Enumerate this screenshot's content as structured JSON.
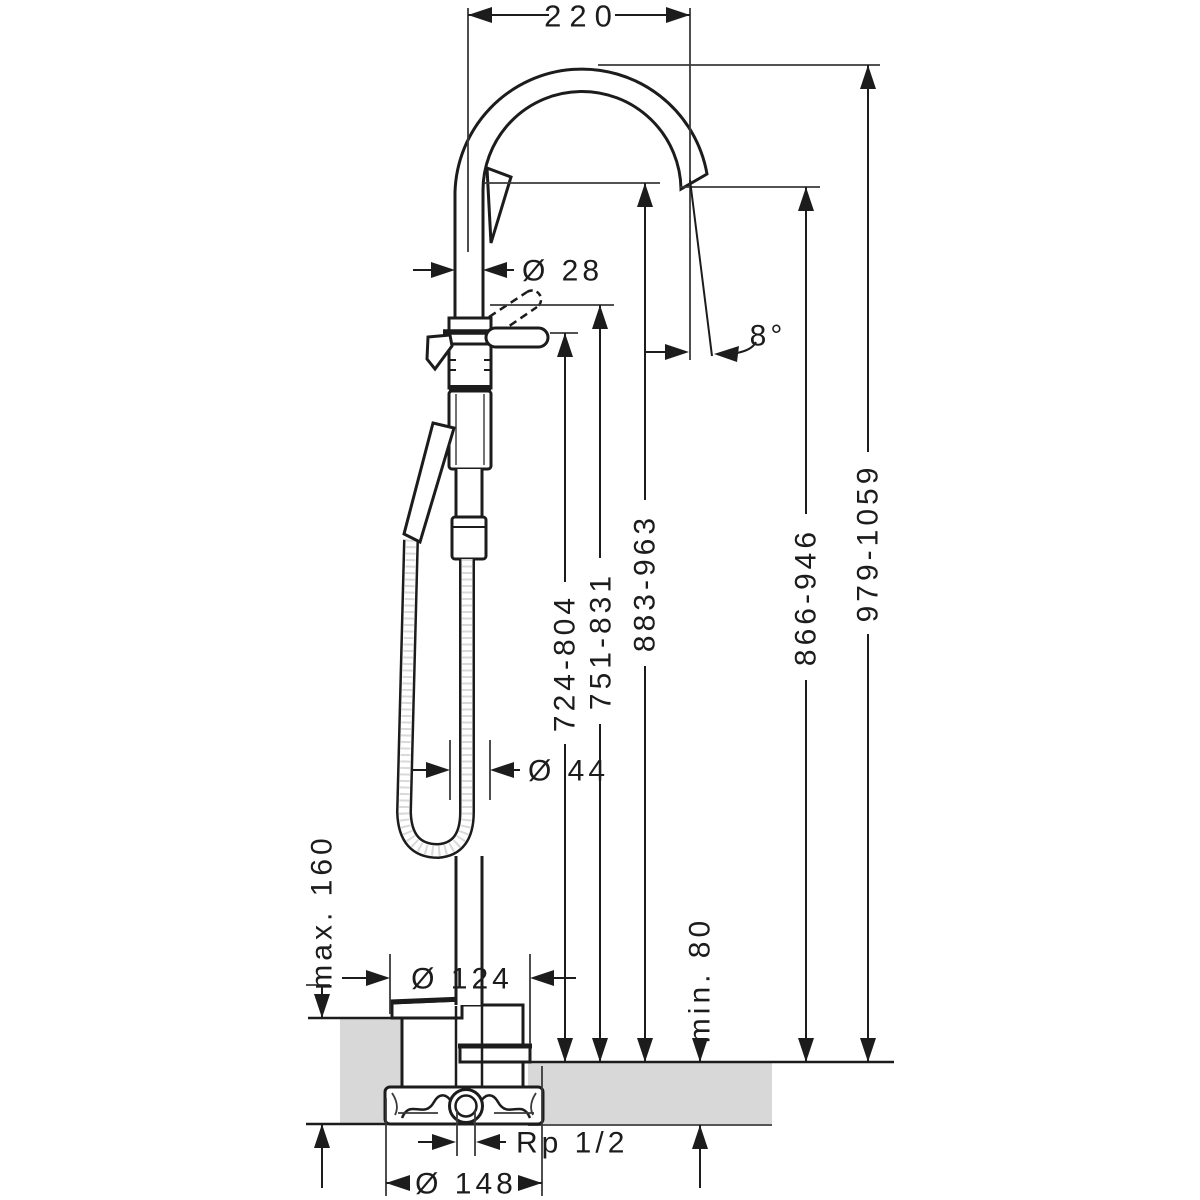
{
  "drawing": {
    "type": "technical-installation-diagram",
    "subject": "freestanding bath mixer with hand shower, side elevation with dimensions",
    "dimensions": {
      "spout_reach": "220",
      "spout_pipe_diameter": "Ø 28",
      "spout_angle": "8°",
      "handle_height": "724-804",
      "handle_raised_height": "751-831",
      "spout_underside_height": "883-963",
      "outlet_height": "866-946",
      "total_height": "979-1059",
      "body_diameter": "Ø 44",
      "max_floor_buildup": "max. 160",
      "min_floor_depth": "min. 80",
      "escutcheon_diameter": "Ø 124",
      "connection_thread": "Rp 1/2",
      "installation_body_diameter": "Ø 148"
    },
    "colors": {
      "line": "#1c1c1c",
      "floor_fill": "#d8d8d8",
      "background": "#ffffff"
    }
  }
}
